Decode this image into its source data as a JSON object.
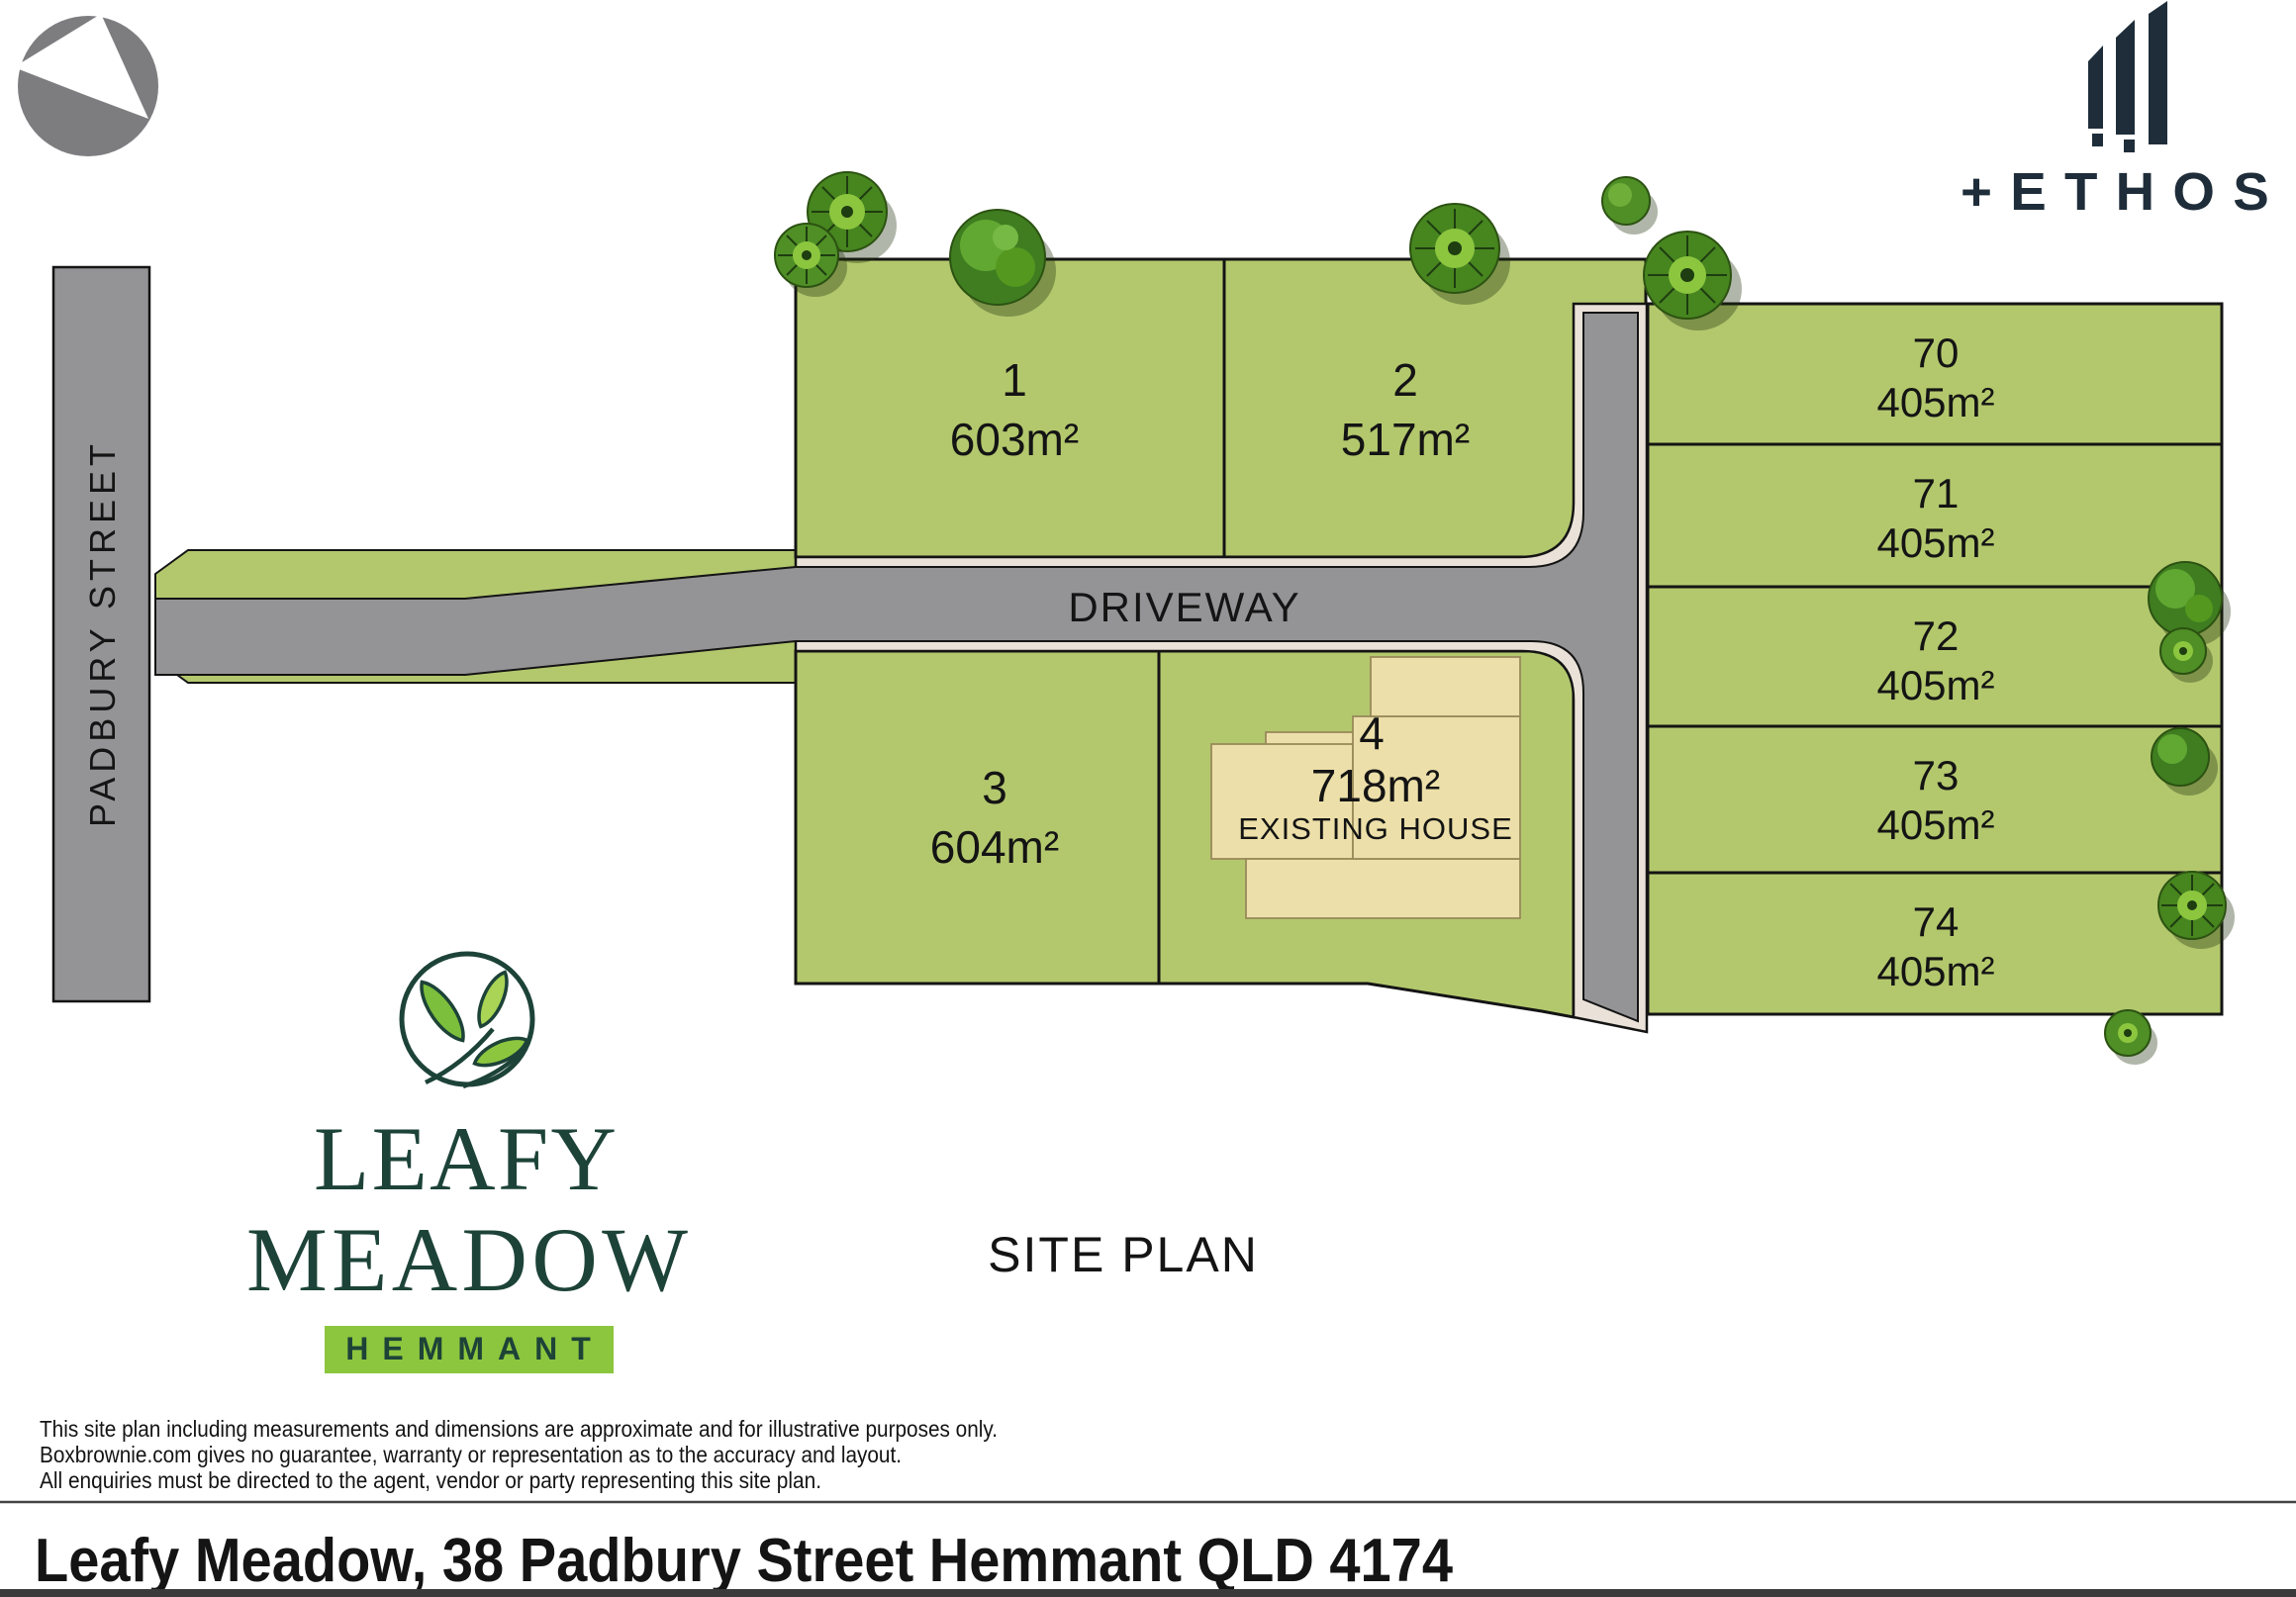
{
  "plan": {
    "title": "SITE PLAN",
    "street_label": "PADBURY STREET",
    "driveway_label": "DRIVEWAY",
    "north_label": "N"
  },
  "lots": [
    {
      "id": "1",
      "area": "603m²"
    },
    {
      "id": "2",
      "area": "517m²"
    },
    {
      "id": "3",
      "area": "604m²"
    },
    {
      "id": "4",
      "area": "718m²",
      "note": "EXISTING HOUSE"
    },
    {
      "id": "70",
      "area": "405m²"
    },
    {
      "id": "71",
      "area": "405m²"
    },
    {
      "id": "72",
      "area": "405m²"
    },
    {
      "id": "73",
      "area": "405m²"
    },
    {
      "id": "74",
      "area": "405m²"
    }
  ],
  "branding": {
    "estate_line1": "LEAFY",
    "estate_line2": "MEADOW",
    "suburb": "HEMMANT",
    "developer": "ETHOS",
    "developer_prefix": "+"
  },
  "disclaimer": [
    "This site plan including measurements and dimensions are approximate and for illustrative purposes only.",
    "Boxbrownie.com gives no guarantee, warranty or representation as to the accuracy and layout.",
    "All enquiries must be directed to the agent, vendor or party representing this site plan."
  ],
  "footer": {
    "address": "Leafy Meadow, 38 Padbury Street Hemmant QLD 4174"
  },
  "colors": {
    "lot_green": "#b3c86d",
    "road_gray": "#949496",
    "road_edge_cream": "#eae2d8",
    "house_beige": "#ecdfa9",
    "brand_dark_green": "#1d4338",
    "brand_bright_green": "#8cc63e",
    "ethos_navy": "#1f2d3a",
    "outline_black": "#141414"
  }
}
